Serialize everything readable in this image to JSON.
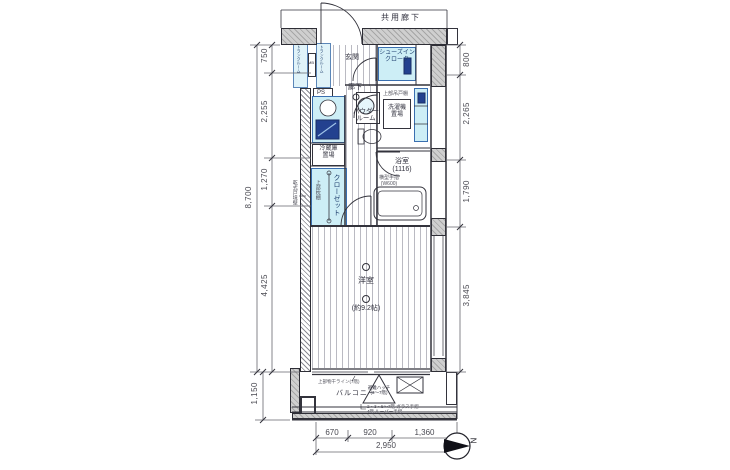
{
  "labels": {
    "common_corridor": "共用廊下",
    "entrance": "玄関",
    "shoes_closet": "シューズイン\nクローク",
    "hallway": "廊下",
    "powder_room": "パウダー\nルーム",
    "upper_cabinet": "上部吊戸棚",
    "washer": "洗濯機\n置場",
    "bath": "浴室\n(1116)",
    "bath_handrail": "横型手摺\n(W600)",
    "fridge": "冷蔵庫\n置場",
    "closet": "クローゼット",
    "closet_shelf": "上部枕棚",
    "party_wall": "乾式戸境壁",
    "room": "洋室",
    "room_size": "(約9.2帖)",
    "balcony": "バルコニー",
    "evac_hatch": "避難ハッチ\n(3〜7階)",
    "laundry_line": "上部物干ライン(7階)",
    "railing_note": "2・3・5〜7階 ガラス手摺\n4階 ルーバー手摺",
    "ps": "PS",
    "mb": "MB",
    "trunk_left": "トランクルーム",
    "trunk_right": "トランクルーム"
  },
  "dimensions": {
    "left_total": "8,700",
    "left_segments": [
      "750",
      "2,255",
      "1,270",
      "4,425"
    ],
    "balcony_depth": "1,150",
    "right_segments": [
      "800",
      "2,265",
      "1,790",
      "3,845"
    ],
    "bottom_segments": [
      "670",
      "920",
      "1,360"
    ],
    "bottom_total": "2,950"
  },
  "compass": {
    "north_label": "N"
  }
}
